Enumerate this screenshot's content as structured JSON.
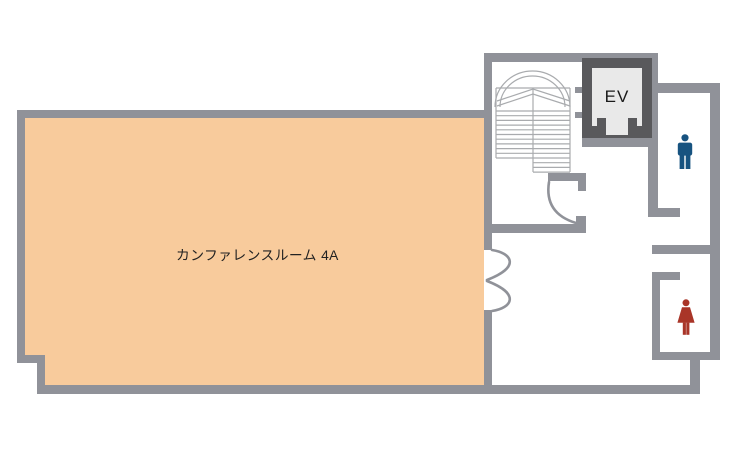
{
  "floorplan": {
    "colors": {
      "wall": "#909299",
      "room_fill": "#F8CB9C",
      "elevator_frame": "#59595C",
      "elevator_interior": "#E9E9E9",
      "stair_lines": "#A9ABAE",
      "male_icon": "#175380",
      "female_icon": "#A93528",
      "label_text": "#222222"
    },
    "rooms": {
      "conference": {
        "label": "カンファレンスルーム 4A"
      },
      "elevator": {
        "label": "EV"
      },
      "stairwell": {
        "icon": "staircase"
      },
      "mens_restroom": {
        "icon": "male-figure"
      },
      "womens_restroom": {
        "icon": "female-figure"
      }
    }
  }
}
